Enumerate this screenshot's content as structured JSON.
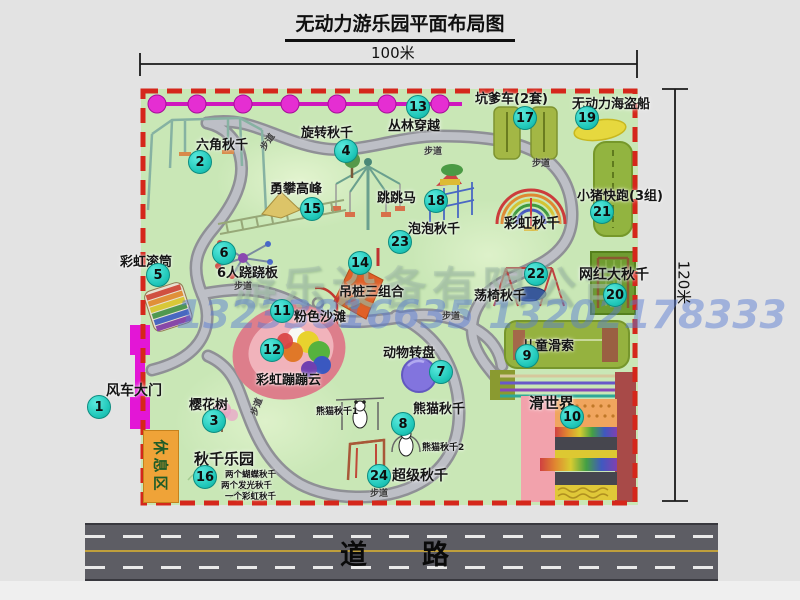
{
  "title": "无动力游乐园平面布局图",
  "dimensions": {
    "top": "100米",
    "right": "120米"
  },
  "road_label": "道　路",
  "watermark": {
    "company": "游乐设备有限公司",
    "phone": "13233816635 13202178333"
  },
  "rest_area_label": "休息区",
  "path_label": "步道",
  "annotations": {
    "rainbow_swing": "彩虹秋千",
    "panda_swing_1": "熊猫秋千1",
    "panda_swing_2": "熊猫秋千2"
  },
  "swing_park_details": [
    "两个蝴蝶秋千",
    "两个发光秋千",
    "一个彩虹秋千"
  ],
  "items": [
    {
      "num": "1",
      "label": "风车大门"
    },
    {
      "num": "2",
      "label": "六角秋千"
    },
    {
      "num": "3",
      "label": "樱花树"
    },
    {
      "num": "4",
      "label": "旋转秋千"
    },
    {
      "num": "5",
      "label": "彩虹滚筒"
    },
    {
      "num": "6",
      "label": "6人跷跷板"
    },
    {
      "num": "7",
      "label": "动物转盘"
    },
    {
      "num": "8",
      "label": "熊猫秋千"
    },
    {
      "num": "9",
      "label": "儿童滑索"
    },
    {
      "num": "10",
      "label": "滑世界"
    },
    {
      "num": "11",
      "label": "粉色沙滩"
    },
    {
      "num": "12",
      "label": "彩虹蹦蹦云"
    },
    {
      "num": "13",
      "label": "丛林穿越"
    },
    {
      "num": "14",
      "label": "吊桩三组合"
    },
    {
      "num": "15",
      "label": "勇攀高峰"
    },
    {
      "num": "16",
      "label": "秋千乐园"
    },
    {
      "num": "17",
      "label": "坑爹车(2套)"
    },
    {
      "num": "18",
      "label": "跳跳马"
    },
    {
      "num": "19",
      "label": "无动力海盗船"
    },
    {
      "num": "20",
      "label": "网红大秋千"
    },
    {
      "num": "21",
      "label": "小猪快跑(3组)"
    },
    {
      "num": "22",
      "label": "荡椅秋千"
    },
    {
      "num": "23",
      "label": "泡泡秋千"
    },
    {
      "num": "24",
      "label": "超级秋千"
    }
  ],
  "colors": {
    "park_green": "#c9e7b6",
    "border_red": "#d5271b",
    "marker_teal": "#1fc7b9",
    "gate_magenta": "#e316d6",
    "zipline_magenta": "#cf17be",
    "road_gray": "#5d5d64",
    "rest_orange": "#efa338",
    "watermark_blue": "#587cd4"
  }
}
